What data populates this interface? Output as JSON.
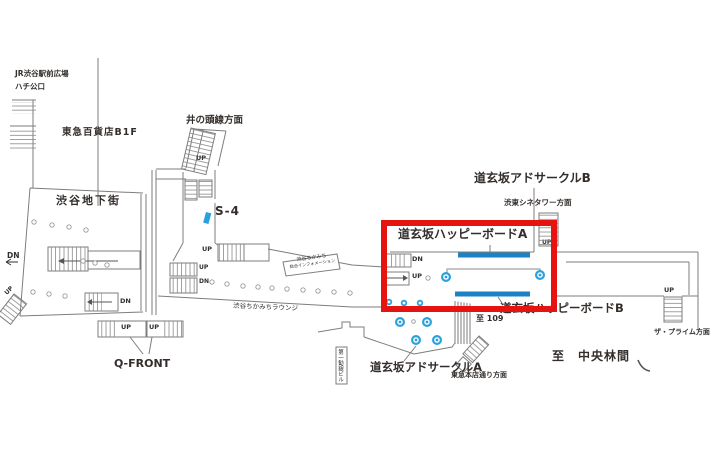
{
  "map": {
    "title_context": "道玄坂 地下通路案内図",
    "areas": {
      "jr_plaza_line1": "JR渋谷駅前広場",
      "jr_plaza_line2": "ハチ公口",
      "tokyu_dept": "東急百貨店B1F",
      "inokashira": "井の頭線方面",
      "shibuya_chikagai": "渋谷地下街",
      "qfront": "Q-FRONT",
      "info_line1": "渋谷ちかみち",
      "info_line2": "総合インフォメーション",
      "lounge": "渋谷ちかみちラウンジ",
      "cine_tower": "渋東シネタワー方面",
      "prime": "ザ・プライム方面",
      "tokyu_honten": "東急本店通り方面",
      "to_109": "至 109",
      "to_chuo_rinkan": "至　中央林間",
      "daiichi_bldg": "第一勧銀ビル"
    },
    "ad_locations": {
      "happy_board_a": "道玄坂ハッピーボードA",
      "happy_board_b": "道玄坂ハッピーボードB",
      "ad_circle_a": "道玄坂アドサークルA",
      "ad_circle_b": "道玄坂アドサークルB",
      "s4": "S-4"
    },
    "stair_labels": {
      "up": "UP",
      "dn": "DN"
    },
    "colors": {
      "highlight_red": "#e51410",
      "board_blue": "#1b82c3",
      "dot_blue": "#2aa1da",
      "wall_gray": "#7d7d7d",
      "text_dark": "#332e2b"
    }
  }
}
